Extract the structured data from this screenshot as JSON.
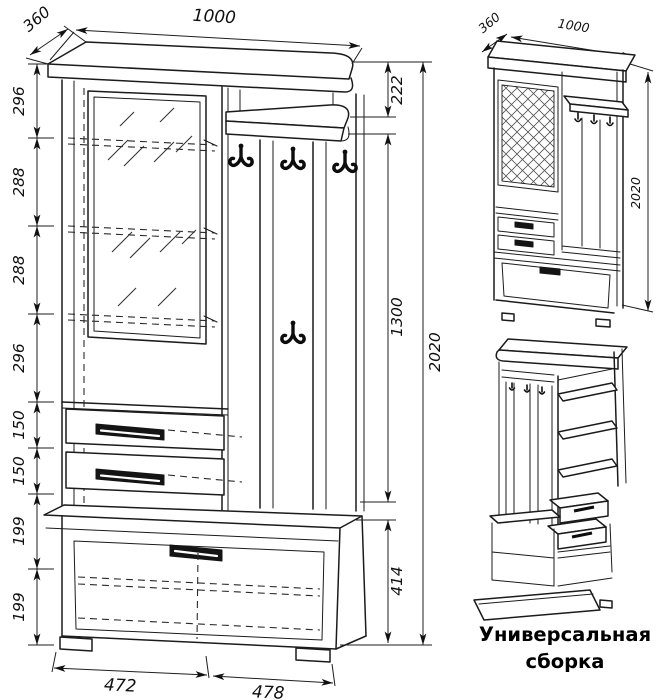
{
  "caption": {
    "line1": "Универсальная",
    "line2": "сборка"
  },
  "main_view": {
    "width_top": "1000",
    "depth_top": "360",
    "left_chain": [
      "296",
      "288",
      "288",
      "296",
      "150",
      "150",
      "199",
      "199"
    ],
    "right_chain": [
      "222",
      "1300",
      "414"
    ],
    "total_height": "2020",
    "bottom_left": "472",
    "bottom_right": "478"
  },
  "assembly_view": {
    "depth": "360",
    "width": "1000",
    "height": "2020"
  },
  "colors": {
    "line": "#1b1b1b",
    "background": "#ffffff",
    "handle": "#141414"
  }
}
